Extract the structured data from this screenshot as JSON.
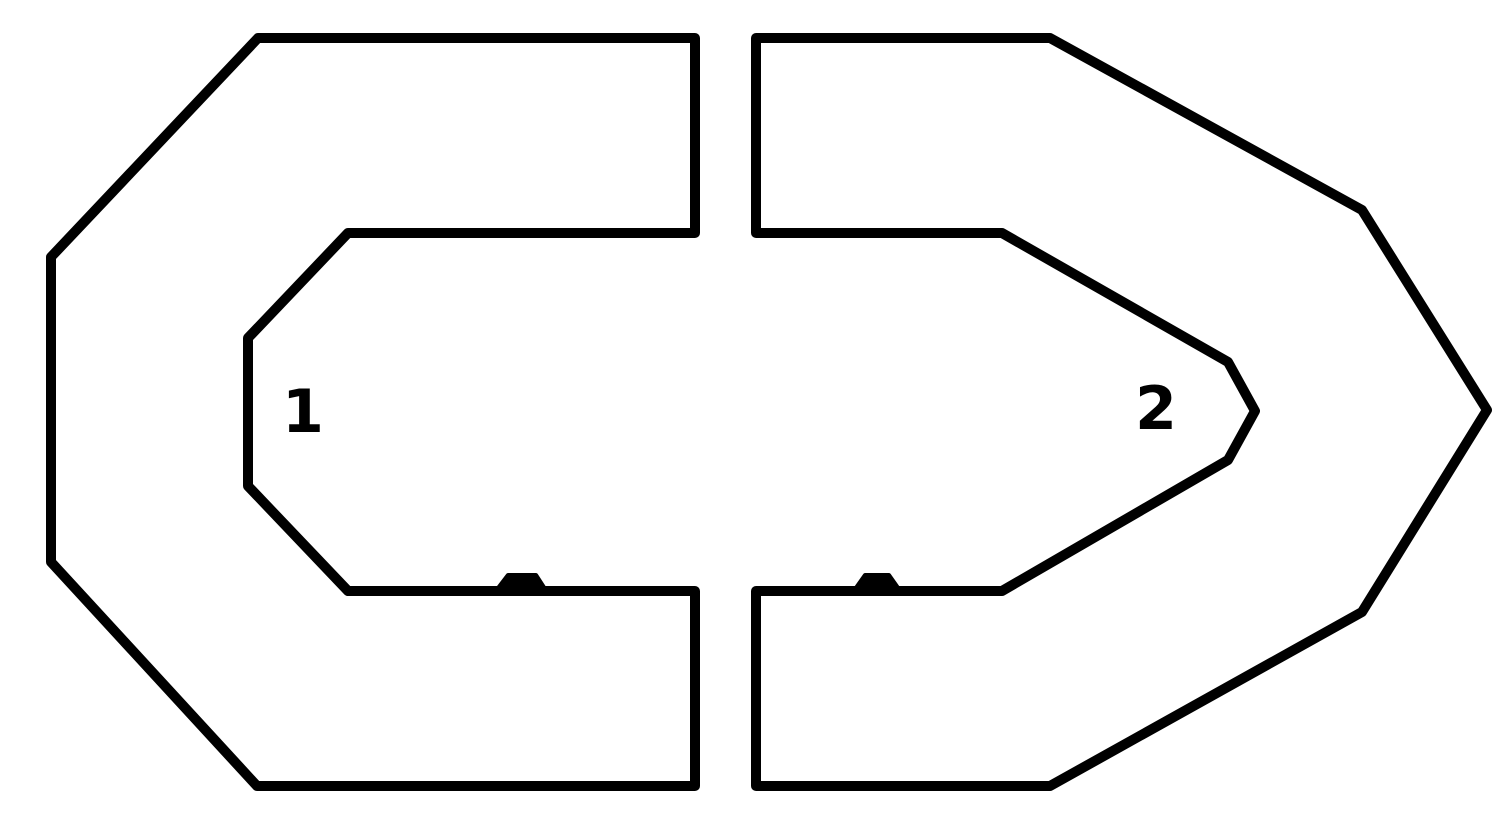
{
  "page": {
    "background_color": "#ffffff"
  },
  "diagram": {
    "description": "Two C-shaped track sections facing each other with a vertical gap in the middle",
    "stroke_color": "#000000",
    "stroke_width": 10,
    "canvas": {
      "width": 1502,
      "height": 825
    },
    "pieces": [
      {
        "id": "section-1",
        "points": [
          [
            695,
            38
          ],
          [
            258,
            38
          ],
          [
            51,
            257
          ],
          [
            51,
            562
          ],
          [
            257,
            786
          ],
          [
            695,
            786
          ],
          [
            695,
            591
          ],
          [
            348,
            591
          ],
          [
            248,
            486
          ],
          [
            248,
            338
          ],
          [
            348,
            233
          ],
          [
            695,
            233
          ]
        ]
      },
      {
        "id": "section-2",
        "points": [
          [
            756,
            38
          ],
          [
            1050,
            38
          ],
          [
            1362,
            210
          ],
          [
            1487,
            410
          ],
          [
            1362,
            612
          ],
          [
            1050,
            786
          ],
          [
            756,
            786
          ],
          [
            756,
            591
          ],
          [
            1002,
            591
          ],
          [
            1228,
            460
          ],
          [
            1255,
            411
          ],
          [
            1228,
            362
          ],
          [
            1002,
            233
          ],
          [
            756,
            233
          ]
        ]
      }
    ],
    "bumps": [
      {
        "id": "bump-left",
        "points": [
          [
            495,
            592
          ],
          [
            508,
            575
          ],
          [
            536,
            575
          ],
          [
            547,
            592
          ]
        ]
      },
      {
        "id": "bump-right",
        "points": [
          [
            853,
            592
          ],
          [
            865,
            575
          ],
          [
            889,
            575
          ],
          [
            901,
            592
          ]
        ]
      }
    ],
    "labels": [
      {
        "text": "1",
        "x": 303,
        "y": 432
      },
      {
        "text": "2",
        "x": 1156,
        "y": 429
      }
    ]
  }
}
